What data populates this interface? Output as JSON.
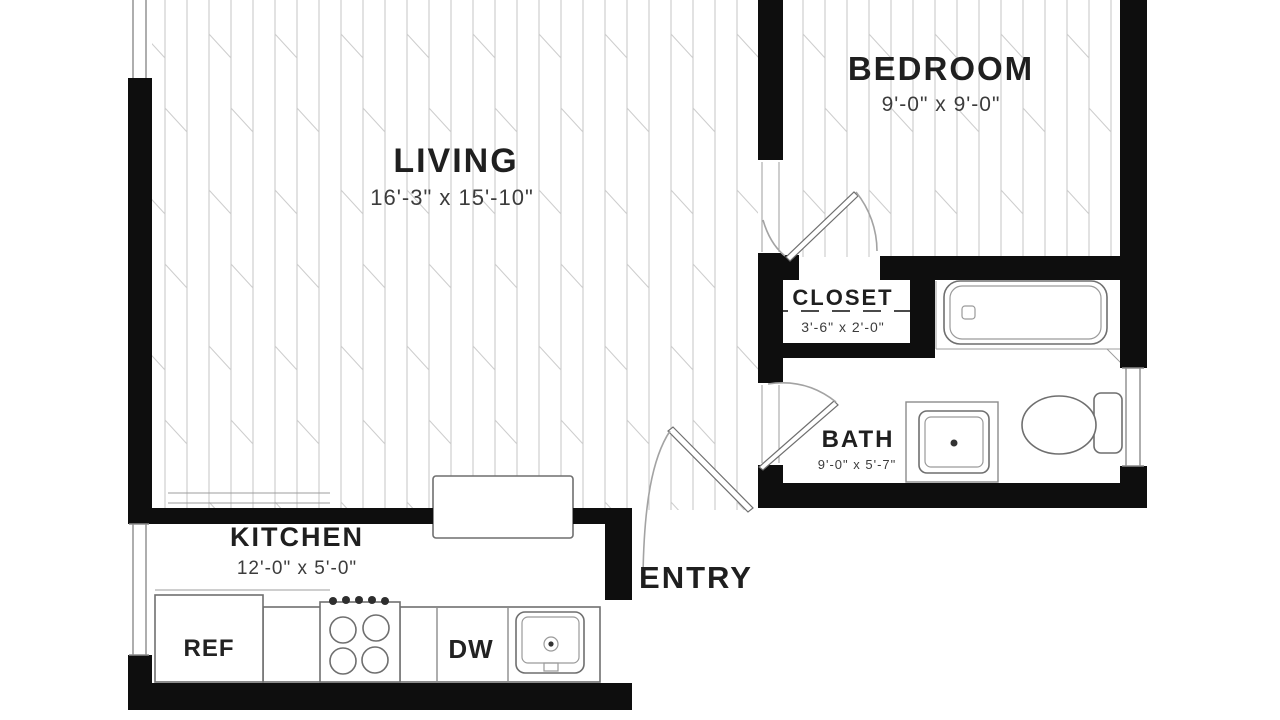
{
  "rooms": {
    "living": {
      "label": "LIVING",
      "dims": "16'-3\" x 15'-10\""
    },
    "bedroom": {
      "label": "BEDROOM",
      "dims": "9'-0\" x 9'-0\""
    },
    "closet": {
      "label": "CLOSET",
      "dims": "3'-6\" x 2'-0\""
    },
    "bath": {
      "label": "BATH",
      "dims": "9'-0\" x 5'-7\""
    },
    "kitchen": {
      "label": "KITCHEN",
      "dims": "12'-0\" x 5'-0\""
    },
    "entry": {
      "label": "ENTRY"
    }
  },
  "appliances": {
    "refrigerator": "REF",
    "dishwasher": "DW"
  },
  "colors": {
    "wall": "#0e0e0e",
    "thin_line": "#8c8c8c",
    "hatch": "#c4c4c4",
    "label_text": "#1f1f1f",
    "dimension_text": "#3c3c3c",
    "background": "#ffffff"
  }
}
